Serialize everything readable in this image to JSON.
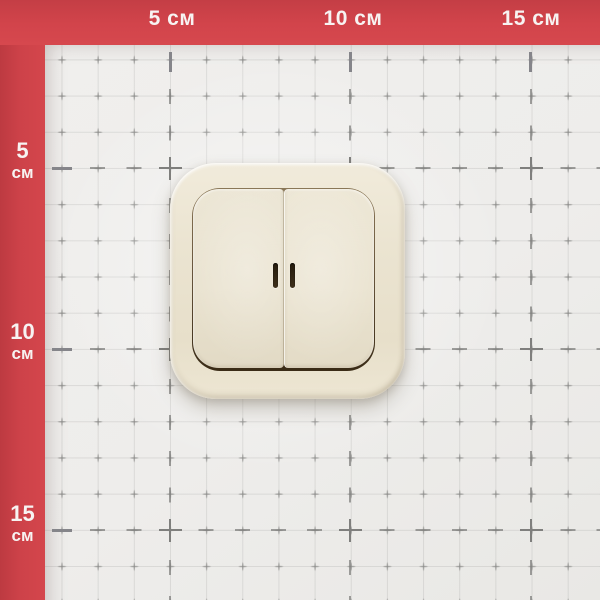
{
  "photo": {
    "subject": "Ivory two-gang wall light switch with indicator windows, photographed on centimeter measurement grid with red ruler frame"
  },
  "rulers": {
    "unit": "см",
    "top": [
      {
        "label": "5 см"
      },
      {
        "label": "10 см"
      },
      {
        "label": "15 см"
      }
    ],
    "left": [
      {
        "value": "5",
        "unit": "см"
      },
      {
        "value": "10",
        "unit": "см"
      },
      {
        "value": "15",
        "unit": "см"
      }
    ]
  },
  "colors": {
    "frame_red": "#d2444b",
    "paper": "#eeedeb",
    "grid_minor": "#8a8a88",
    "grid_major": "#7f7f7d",
    "label_text": "#f7f3f2",
    "switch_ivory": "#ebe4d1",
    "recess_brown": "#5c4a32",
    "slot_dark": "#2c2213"
  }
}
